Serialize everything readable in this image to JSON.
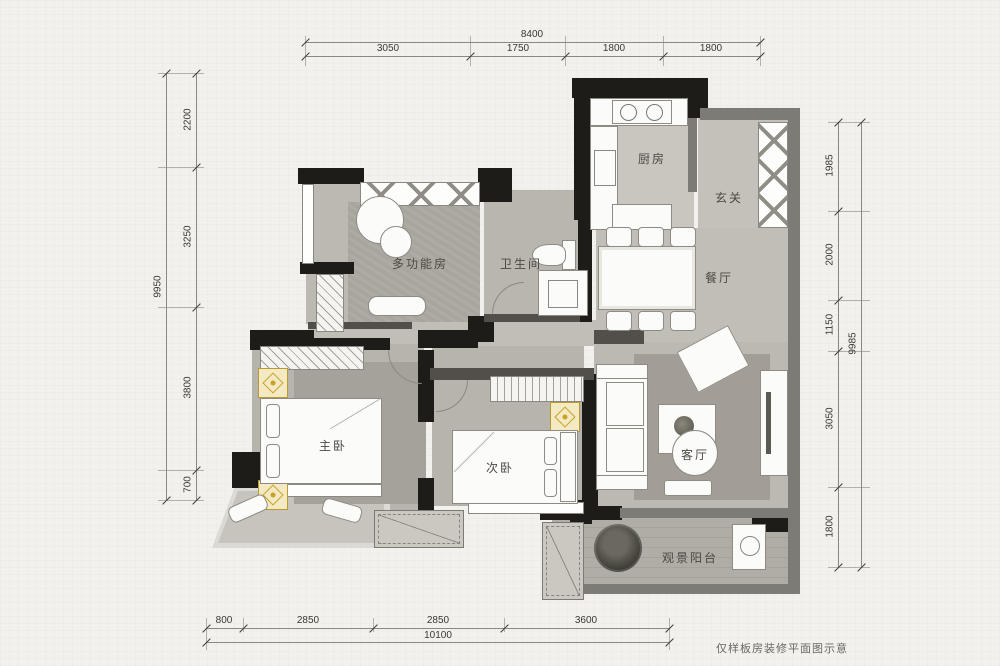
{
  "caption": "仅样板房装修平面图示意",
  "rooms": {
    "kitchen": "厨房",
    "entry": "玄关",
    "bathroom": "卫生间",
    "multifunction": "多功能房",
    "dining": "餐厅",
    "master_bedroom": "主卧",
    "second_bedroom": "次卧",
    "living": "客厅",
    "balcony": "观景阳台"
  },
  "dimensions": {
    "top": {
      "overall": "8400",
      "segments": [
        "3050",
        "1750",
        "1800",
        "1800"
      ]
    },
    "left": {
      "overall": "9950",
      "segments": [
        "2200",
        "3250",
        "3800",
        "700"
      ]
    },
    "right": {
      "overall": "9985",
      "segments": [
        "1985",
        "2000",
        "1150",
        "3050",
        "1800"
      ]
    },
    "bottom": {
      "overall": "10100",
      "segments": [
        "800",
        "2850",
        "2850",
        "3600"
      ]
    }
  },
  "colors": {
    "wall": "#1d1c19",
    "floor_gray": "#bdbab4",
    "accent_gold": "#c9a227",
    "paper": "#f2f1ee"
  }
}
